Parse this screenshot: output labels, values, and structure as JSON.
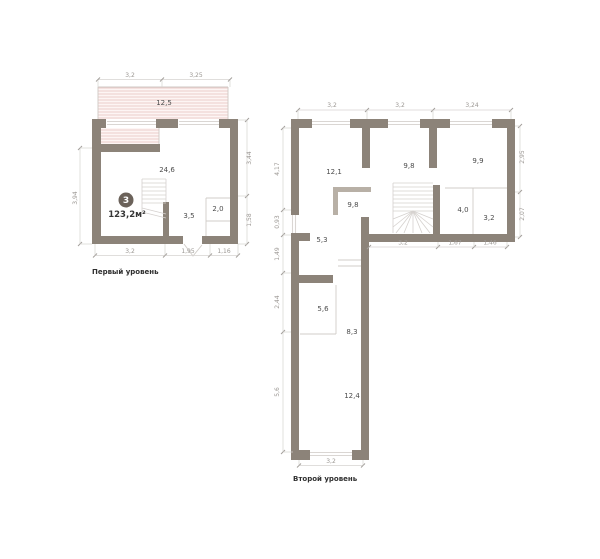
{
  "plans": {
    "level1": {
      "label": "Первый уровень",
      "badge_number": "3",
      "total_area": "123,2м²",
      "rooms": [
        "12,5",
        "24,6",
        "3,5",
        "2,0"
      ],
      "dims": {
        "top": [
          "3,2",
          "3,25"
        ],
        "left": [
          "3,94"
        ],
        "right": [
          "3,44",
          "1,58"
        ],
        "bottom": [
          "3,2",
          "1,95",
          "1,16"
        ]
      }
    },
    "level2": {
      "label": "Второй уровень",
      "rooms": [
        "12,1",
        "9,8",
        "9,9",
        "9,8",
        "4,0",
        "3,2",
        "5,3",
        "5,6",
        "8,3",
        "12,4"
      ],
      "dims": {
        "top": [
          "3,2",
          "3,2",
          "3,24"
        ],
        "left": [
          "4,17",
          "0,93",
          "1,49",
          "2,44",
          "5,6"
        ],
        "right": [
          "2,95",
          "2,07"
        ],
        "inner_bottom": [
          "3,2",
          "1,67",
          "1,46"
        ],
        "bottom": [
          "3,2"
        ]
      }
    }
  },
  "colors": {
    "wall": "#8c8379",
    "half_wall": "#b8b0a6",
    "badge": "#6b625a",
    "terrace_hatch": "#eac9c5",
    "dim_text": "#9b9793",
    "room_text": "#4c4c4c"
  }
}
